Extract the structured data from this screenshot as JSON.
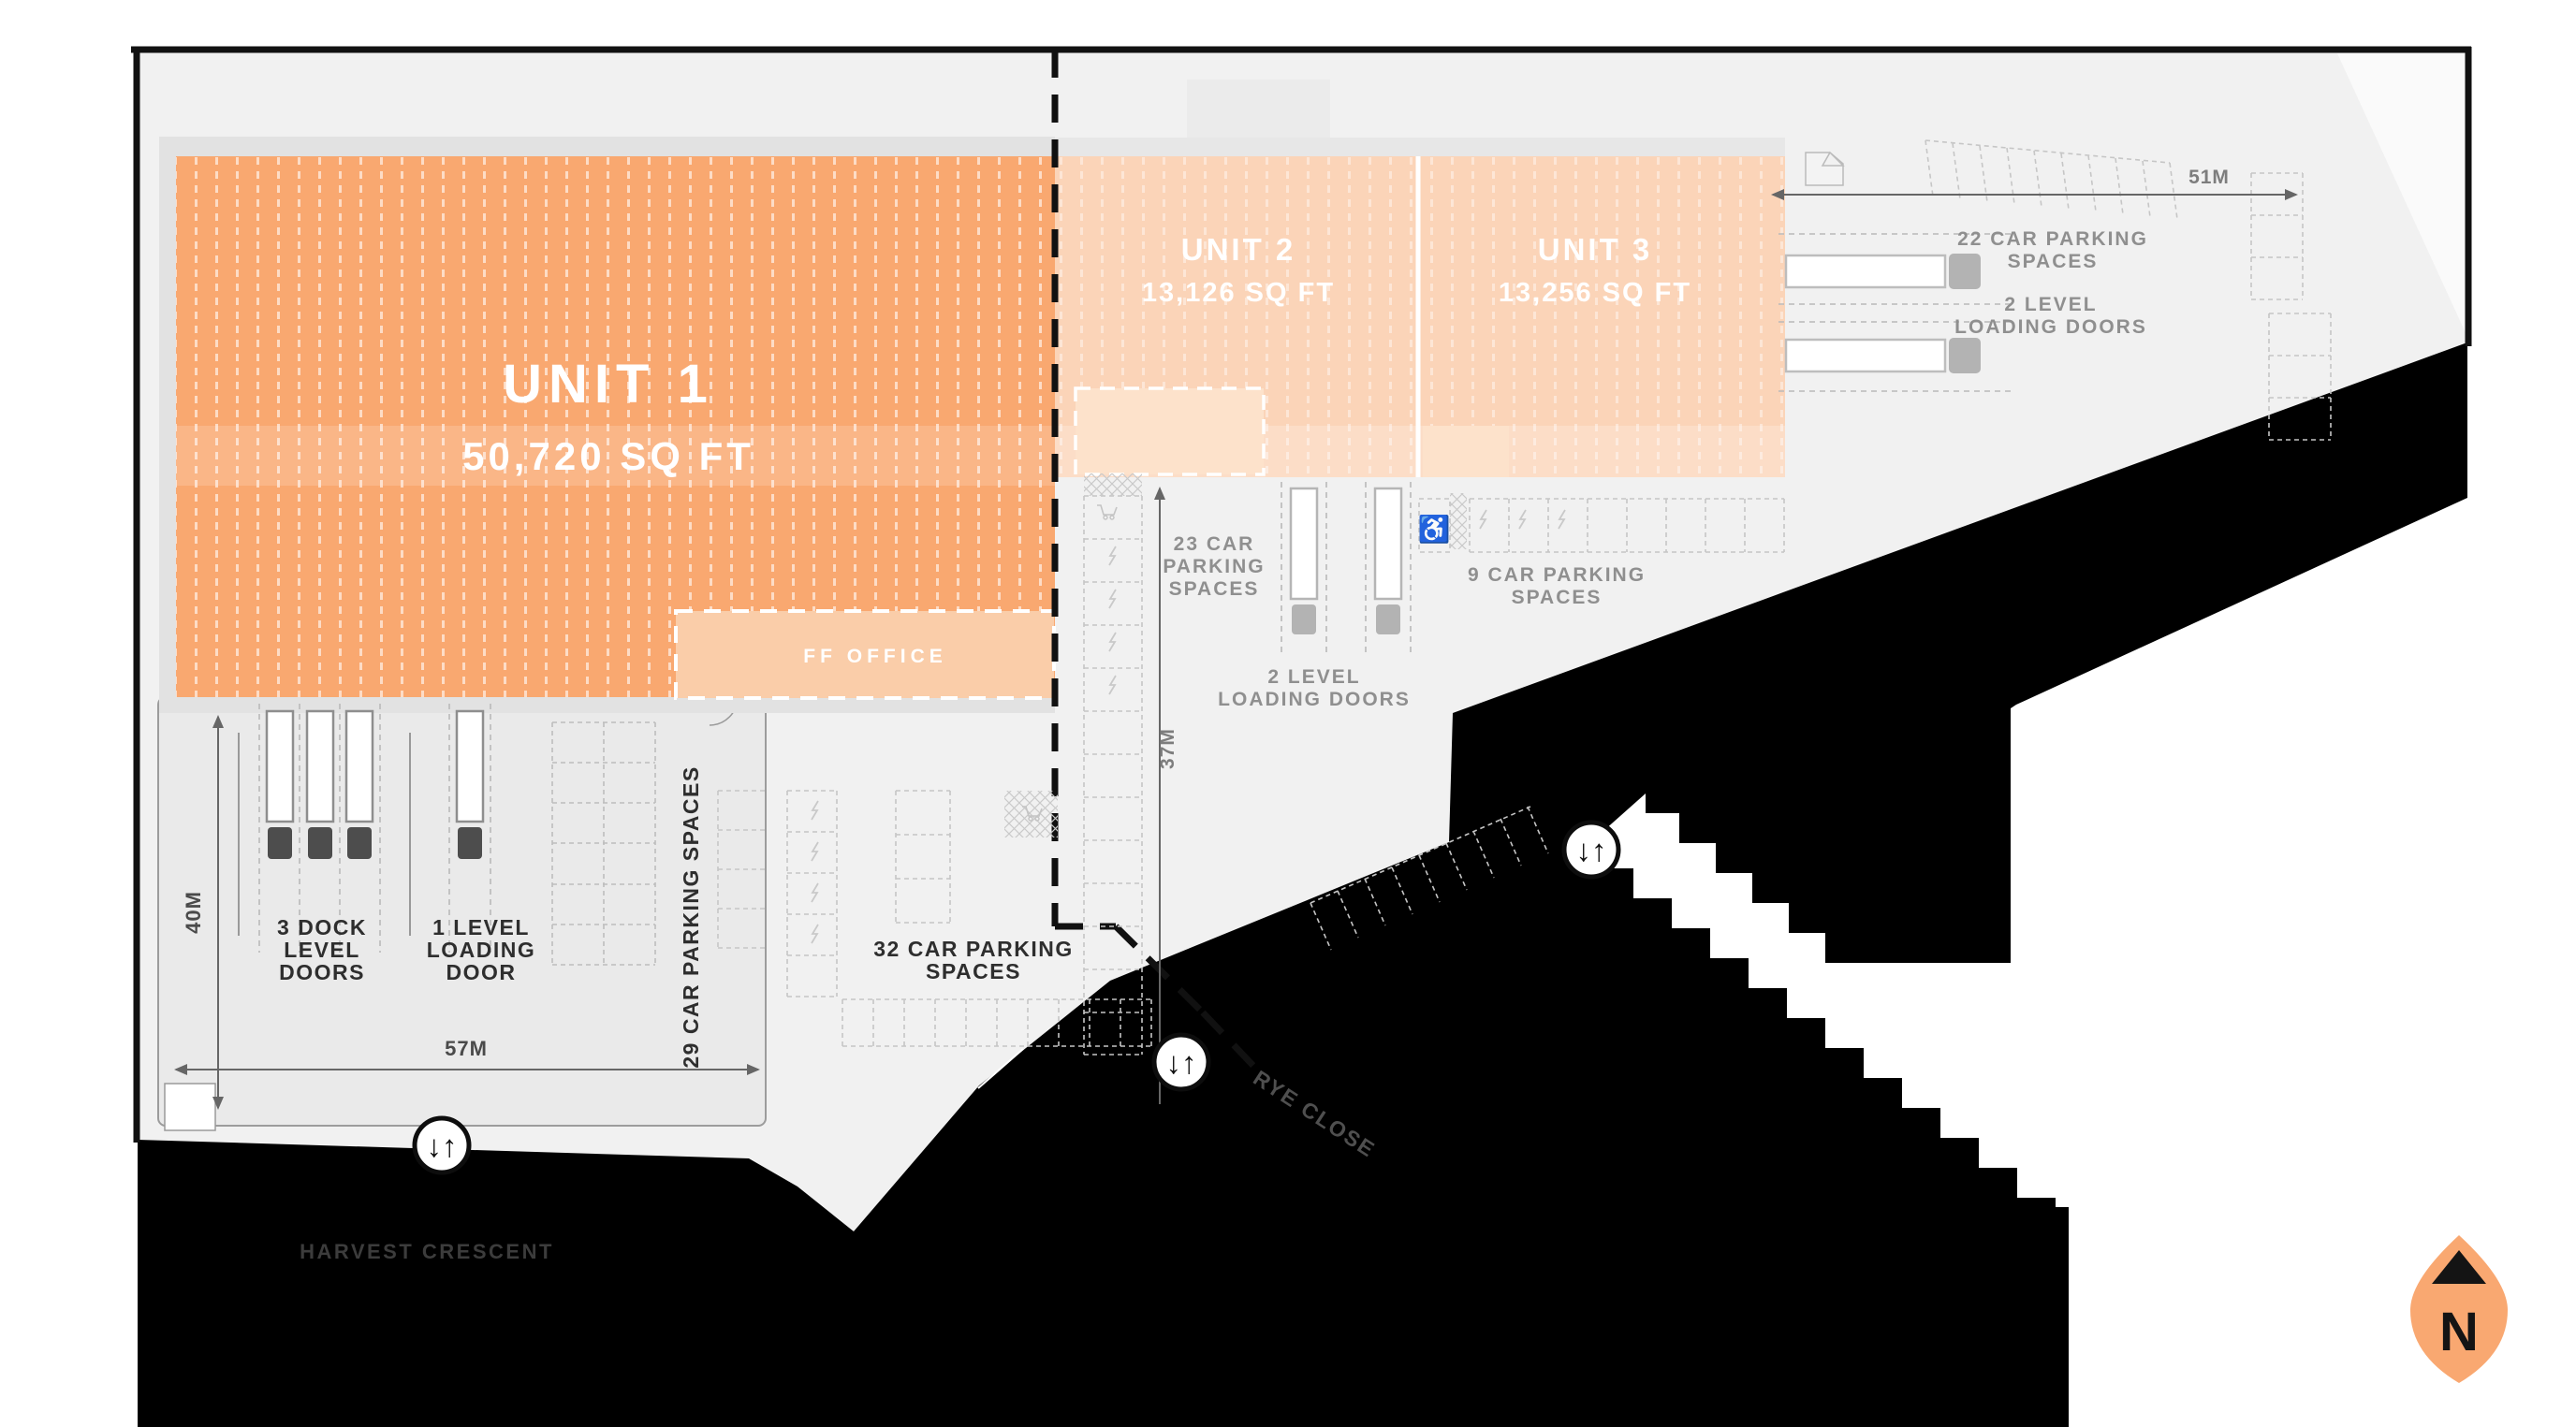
{
  "plan": {
    "units": [
      {
        "name": "UNIT 1",
        "area": "50,720 SQ FT"
      },
      {
        "name": "UNIT 2",
        "area": "13,126 SQ FT"
      },
      {
        "name": "UNIT 3",
        "area": "13,256 SQ FT"
      }
    ],
    "office_label": "FF OFFICE",
    "yard": {
      "dock_doors": [
        "3 DOCK",
        "LEVEL",
        "DOORS"
      ],
      "loading_door": [
        "1 LEVEL",
        "LOADING",
        "DOOR"
      ],
      "parking_29": "29 CAR PARKING SPACES",
      "width": "57M",
      "depth": "40M"
    },
    "parking": {
      "p32": [
        "32 CAR PARKING",
        "SPACES"
      ],
      "p23": [
        "23 CAR",
        "PARKING",
        "SPACES"
      ],
      "p9": [
        "9 CAR PARKING",
        "SPACES"
      ],
      "p22": [
        "22 CAR PARKING",
        "SPACES"
      ]
    },
    "loading": {
      "center": [
        "2 LEVEL",
        "LOADING DOORS"
      ],
      "east": [
        "2 LEVEL",
        "LOADING DOORS"
      ]
    },
    "dims": {
      "d37": "37M",
      "d51": "51M"
    },
    "streets": {
      "harvest": "HARVEST CRESCENT",
      "rye": "RYE CLOSE"
    },
    "compass_n": "N",
    "access_glyph": "↓↑"
  },
  "colors": {
    "unit1": "#F9A870",
    "unit23": "#FBD4B8",
    "office": "#FACDA9",
    "subroom": "#FDE2CB",
    "road": "#000000",
    "site": "#F1F1F1",
    "north": "#F9A871"
  }
}
